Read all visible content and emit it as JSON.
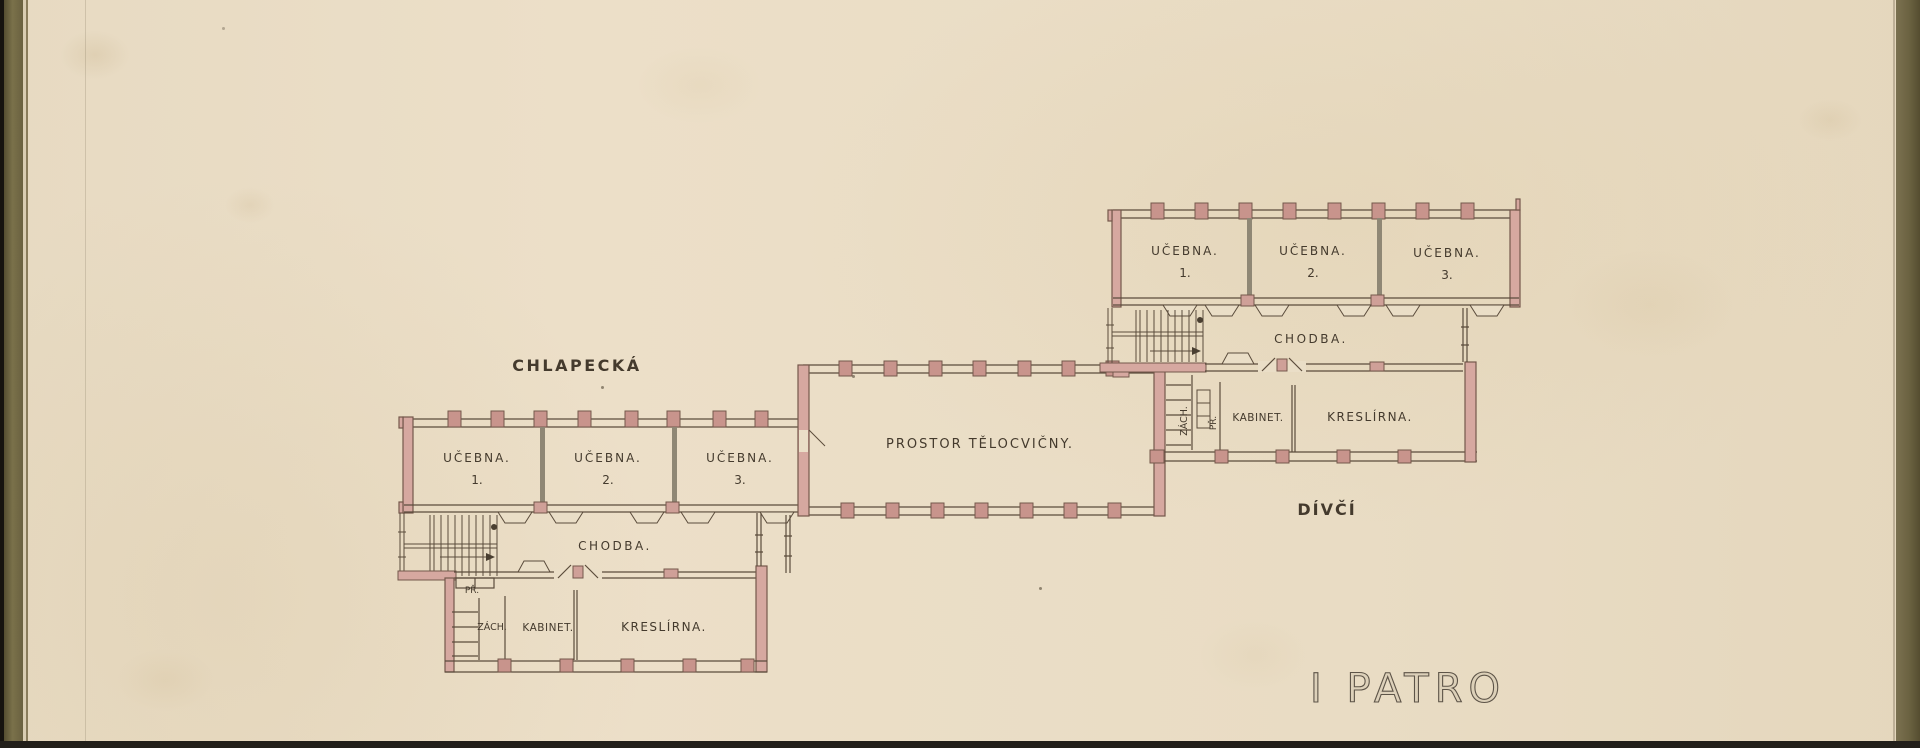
{
  "page": {
    "floor_title": "I PATRO"
  },
  "labels": {
    "boys_wing": "CHLAPECKÁ",
    "girls_wing": "DÍVČÍ",
    "gym": "PROSTOR TĚLOCVIČNY."
  },
  "boys_wing": {
    "classrooms": [
      {
        "name": "UČEBNA.",
        "number": "1."
      },
      {
        "name": "UČEBNA.",
        "number": "2."
      },
      {
        "name": "UČEBNA.",
        "number": "3."
      }
    ],
    "corridor": "CHODBA.",
    "vestibule": "PŘ.",
    "toilet": "ZÁCH.",
    "cabinet": "KABINET.",
    "drawing_room": "KRESLÍRNA."
  },
  "girls_wing": {
    "classrooms": [
      {
        "name": "UČEBNA.",
        "number": "1."
      },
      {
        "name": "UČEBNA.",
        "number": "2."
      },
      {
        "name": "UČEBNA.",
        "number": "3."
      }
    ],
    "corridor": "CHODBA.",
    "vestibule": "PŘ.",
    "toilet": "ZÁCH.",
    "cabinet": "KABINET.",
    "drawing_room": "KRESLÍRNA."
  },
  "colors": {
    "paper": "#eadec7",
    "wall_pink": "#d6a8a0",
    "pier_pink": "#c8948c",
    "ink": "#5b4c3c",
    "mat_olive": "#6e6543"
  }
}
